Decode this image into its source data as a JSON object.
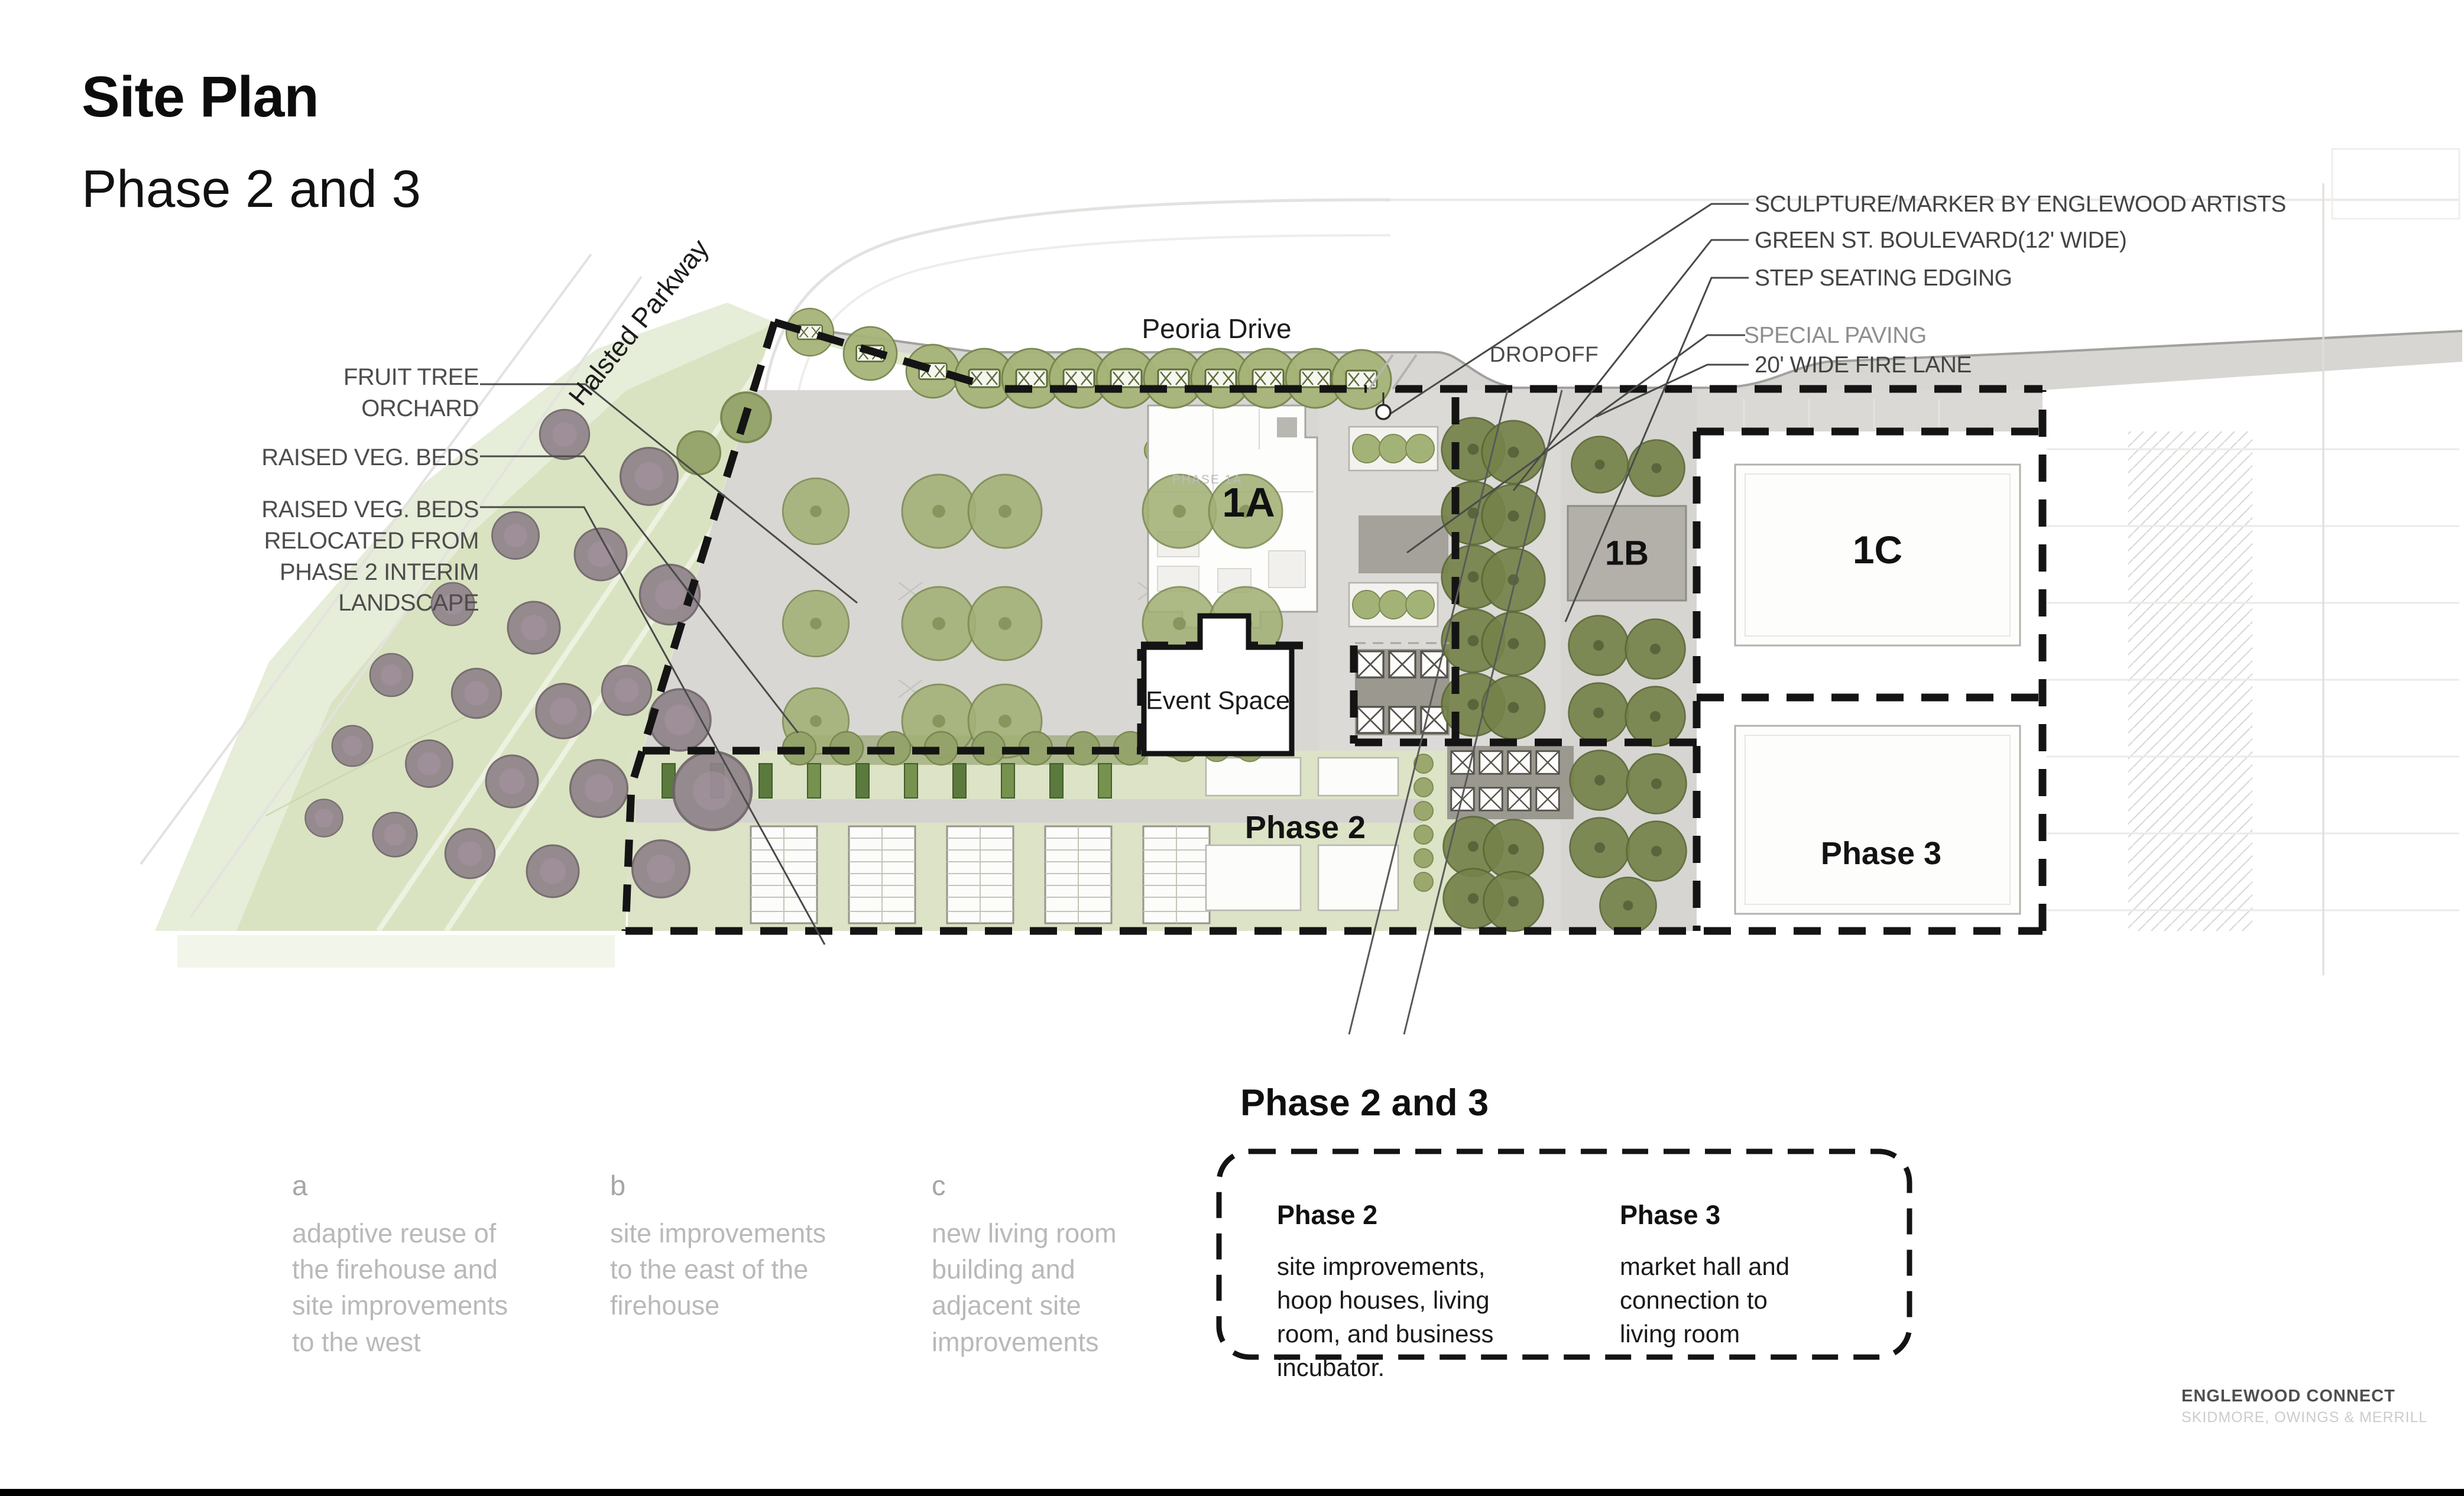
{
  "slide": {
    "title": "Site Plan",
    "subtitle": "Phase 2 and 3"
  },
  "plan": {
    "streets": {
      "halsted": "Halsted Parkway",
      "peoria": "Peoria Drive",
      "dropoff": "DROPOFF"
    },
    "left_callouts": [
      "FRUIT TREE\nORCHARD",
      "RAISED VEG. BEDS",
      "RAISED VEG. BEDS\nRELOCATED FROM\nPHASE 2 INTERIM\nLANDSCAPE"
    ],
    "right_callouts": [
      "SCULPTURE/MARKER BY ENGLEWOOD ARTISTS",
      "GREEN ST. BOULEVARD(12' WIDE)",
      "STEP SEATING EDGING",
      "SPECIAL PAVING",
      "20' WIDE FIRE LANE"
    ],
    "labels": {
      "phase1a_tag": "PHASE 1A",
      "building_1a": "1A",
      "building_1b": "1B",
      "building_1c": "1C",
      "event_space": "Event Space",
      "phase2_area": "Phase 2",
      "phase3_area": "Phase 3"
    }
  },
  "legend": {
    "columns": [
      {
        "key": "a",
        "text": "adaptive reuse of\nthe firehouse and\nsite improvements\nto the west"
      },
      {
        "key": "b",
        "text": "site improvements\nto the east of the\nfirehouse"
      },
      {
        "key": "c",
        "text": "new living room\nbuilding and\nadjacent site\nimprovements"
      }
    ],
    "phase_box": {
      "heading": "Phase 2 and 3",
      "phase2_title": "Phase 2",
      "phase2_text": "site improvements,\nhoop houses, living\nroom, and business\nincubator.",
      "phase3_title": "Phase 3",
      "phase3_text": "market hall and\nconnection to\nliving room"
    }
  },
  "footer": {
    "project": "ENGLEWOOD CONNECT",
    "firm": "SKIDMORE, OWINGS & MERRILL"
  },
  "colors": {
    "boundary": "#141414",
    "parkway_green": "#dbe5c3",
    "plaza_gray": "#d9d7d3",
    "tree_olive": "#a2b176",
    "tree_dark": "#75834a",
    "tree_purple": "#8e8189",
    "paving_dark": "#a5a29c",
    "muted_text": "#b9b9b9",
    "callout_text": "#444444"
  }
}
